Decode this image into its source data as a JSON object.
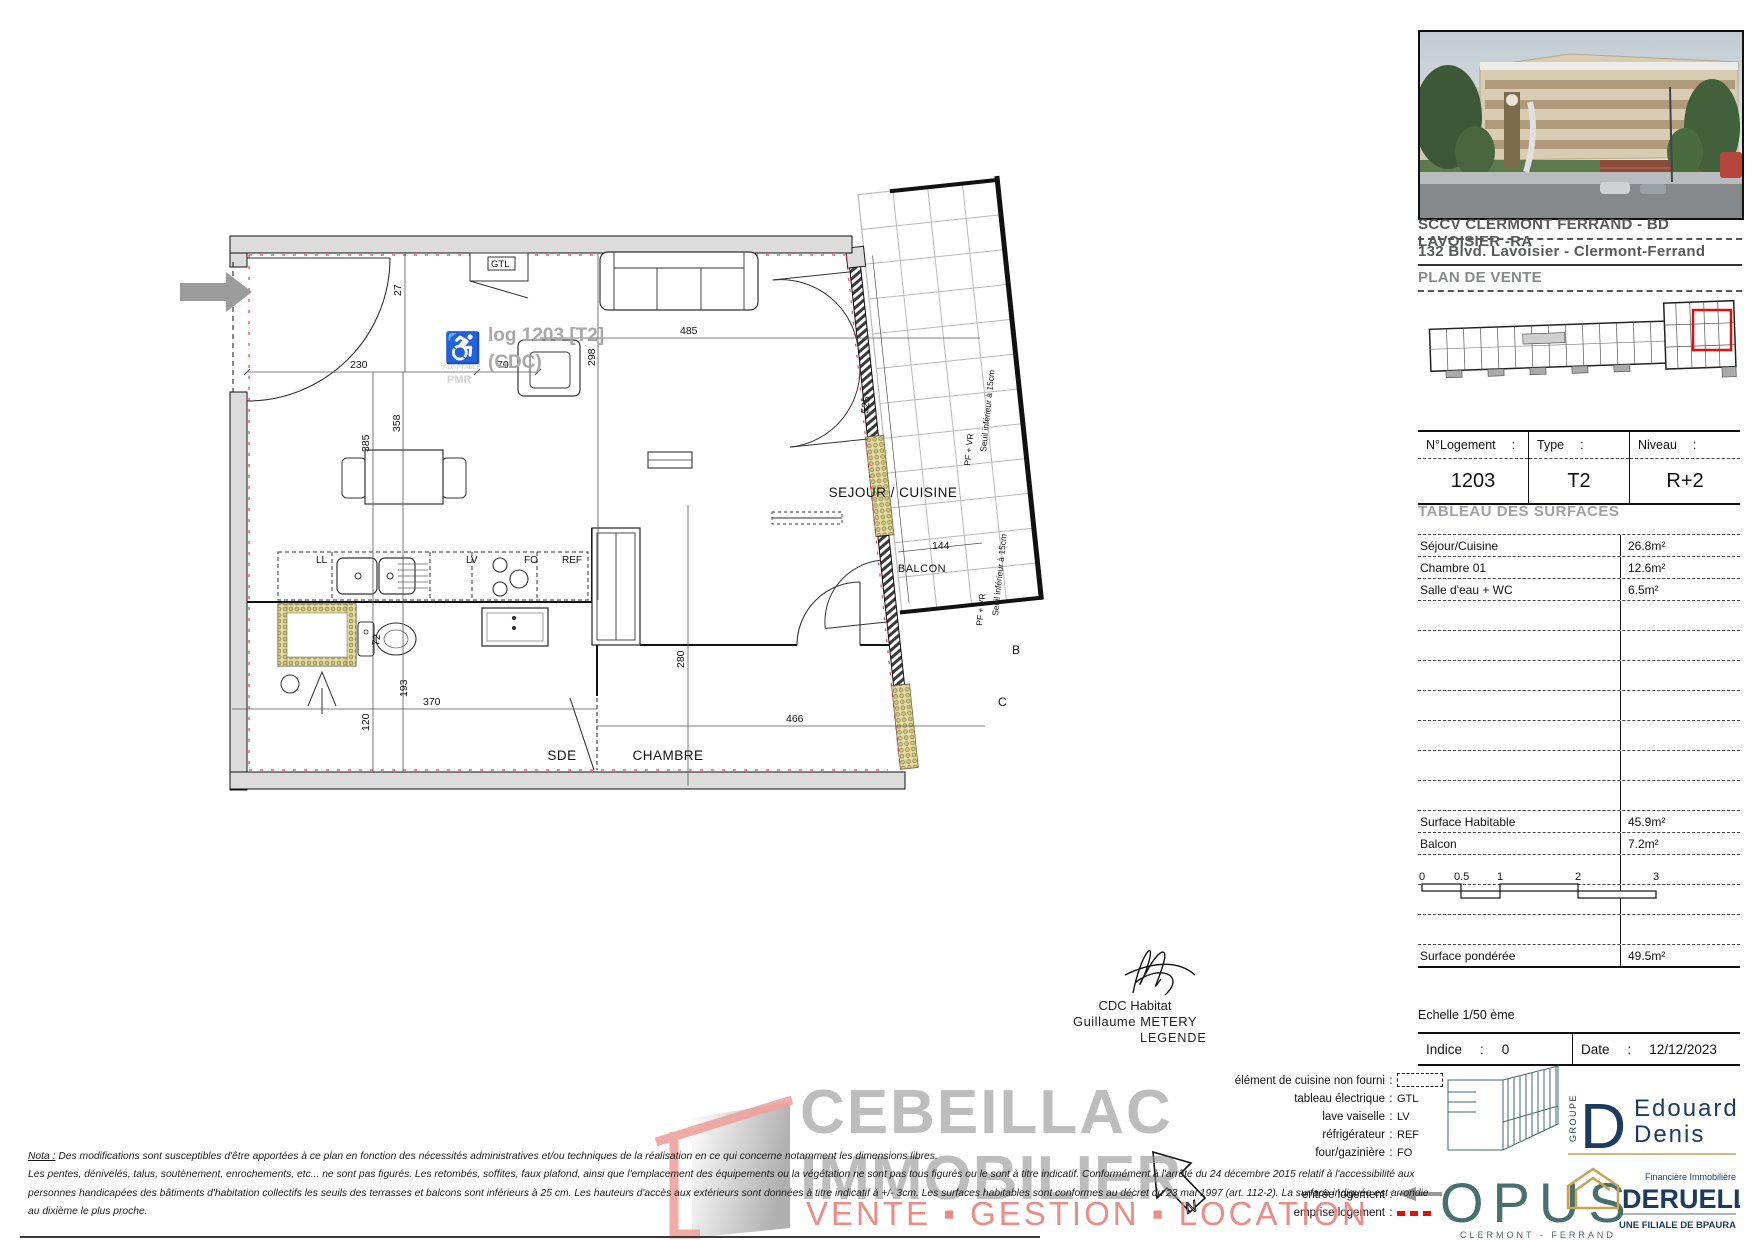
{
  "plan": {
    "watermark_line1": "log 1203 [T2]",
    "watermark_line2": "(CDC)",
    "adaptable": "ADAPTABLE",
    "pmr": "PMR",
    "room_sejour": "SEJOUR / CUISINE",
    "room_chambre": "CHAMBRE",
    "room_sde": "SDE",
    "room_balcon": "BALCON",
    "fix_gtl": "GTL",
    "fix_ll": "LL",
    "fix_lv": "LV",
    "fix_fo": "FO",
    "fix_ref": "REF",
    "dim_230": "230",
    "dim_27": "27",
    "dim_70": "70",
    "dim_485": "485",
    "dim_298": "298",
    "dim_358": "358",
    "dim_385": "385",
    "dim_525": "525",
    "dim_144": "144",
    "dim_280": "280",
    "dim_466": "466",
    "dim_370": "370",
    "dim_120": "120",
    "dim_193": "193",
    "dim_72": "72",
    "win_label": "PF + VR",
    "seuil_label": "Seuil inférieur à 15cm",
    "section_b": "B",
    "section_c": "C"
  },
  "panel": {
    "title1": "SCCV CLERMONT FERRAND - BD LAVOISIER -RA",
    "title2": "132 Blvd. Lavoisier - Clermont-Ferrand",
    "title3": "PLAN DE VENTE",
    "unit": {
      "c1l": "N°Logement",
      "c2l": "Type",
      "c3l": "Niveau",
      "colon": ":",
      "c1v": "1203",
      "c2v": "T2",
      "c3v": "R+2"
    },
    "surfaces_title": "TABLEAU DES SURFACES",
    "surfaces": [
      {
        "label": "Séjour/Cuisine",
        "value": "26.8m²"
      },
      {
        "label": "Chambre 01",
        "value": "12.6m²"
      },
      {
        "label": "Salle d'eau + WC",
        "value": "6.5m²"
      },
      {
        "label": "",
        "value": ""
      },
      {
        "label": "",
        "value": ""
      },
      {
        "label": "",
        "value": ""
      },
      {
        "label": "",
        "value": ""
      },
      {
        "label": "",
        "value": ""
      },
      {
        "label": "",
        "value": ""
      },
      {
        "label": "",
        "value": ""
      },
      {
        "label": "Surface Habitable",
        "value": "45.9m²"
      },
      {
        "label": "Balcon",
        "value": "7.2m²"
      },
      {
        "label": "",
        "value": ""
      },
      {
        "label": "",
        "value": ""
      },
      {
        "label": "",
        "value": ""
      },
      {
        "label": "Surface pondérée",
        "value": "49.5m²"
      }
    ],
    "scale_ticks": [
      "0",
      "0.5",
      "1",
      "2",
      "3"
    ],
    "echelle": "Echelle 1/50 ème",
    "indice_label": "Indice",
    "indice_value": "0",
    "date_label": "Date",
    "date_value": "12/12/2023",
    "colon": ":"
  },
  "signature": {
    "line1": "CDC Habitat",
    "line2": "Guillaume METERY"
  },
  "legend": {
    "title": "LEGENDE",
    "colon": ":",
    "items": [
      {
        "label": "élément de cuisine non fourni",
        "symbol": "dashed-rect"
      },
      {
        "label": "tableau électrique",
        "value": "GTL"
      },
      {
        "label": "lave vaiselle",
        "value": "LV"
      },
      {
        "label": "réfrigérateur",
        "value": "REF"
      },
      {
        "label": "four/gazinière",
        "value": "FO"
      }
    ],
    "items2": [
      {
        "label": "entrée logement",
        "symbol": "gray-arrow"
      },
      {
        "label": "emprise logement",
        "symbol": "red-dashes"
      }
    ]
  },
  "nota": {
    "label": "Nota :",
    "line1": " Des modifications sont susceptibles d'être apportées à ce plan en fonction des nécessités administratives et/ou techniques de la réalisation en ce qui concerne notamment les dimensions libres.",
    "line2": "Les pentes, dénivelés, talus, soutènement, enrochements, etc... ne sont pas figurés. Les retombés, soffites, faux plafond, ainsi que l'emplacement des équipements ou la végétation ne sont pas tous figurés ou le sont à titre indicatif. Conformément à l'arrêté du 24 décembre 2015 relatif à l'accessibilité aux",
    "line3": "personnes handicapées des bâtiments d'habitation collectifs les seuils des terrasses et balcons sont inférieurs à 25 cm. Les hauteurs d'accès aux extérieurs sont données à titre indicatif à +/- 3cm. Les surfaces habitables sont conformes au décret du 23 mai 1997 (art. 112-2). La surface indiquée est arrondie",
    "line4": "au dixième le plus proche."
  },
  "watermark": {
    "line1": "CEBEILLAC",
    "line2": "IMMOBILIER",
    "line3": "VENTE ▪ GESTION ▪ LOCATION"
  },
  "logos": {
    "groupe": "GROUPE",
    "ed_monogram": "D",
    "ed1": "Edouard",
    "ed2": "Denis",
    "opus": "OPUS",
    "opus_sub": "CLERMONT - FERRAND",
    "deruelle_top": "Financière Immobilière",
    "deruelle": "DERUELLE",
    "deruelle_sub": "UNE FILIALE DE BPAURA"
  },
  "colors": {
    "accent_red": "#e01010",
    "salmon": "#f0a29e",
    "navy": "#1d3a60",
    "teal": "#40696a",
    "gold": "#c9a44e",
    "wall_gray": "#dcdcdc",
    "watermark_gray": "#949494"
  }
}
